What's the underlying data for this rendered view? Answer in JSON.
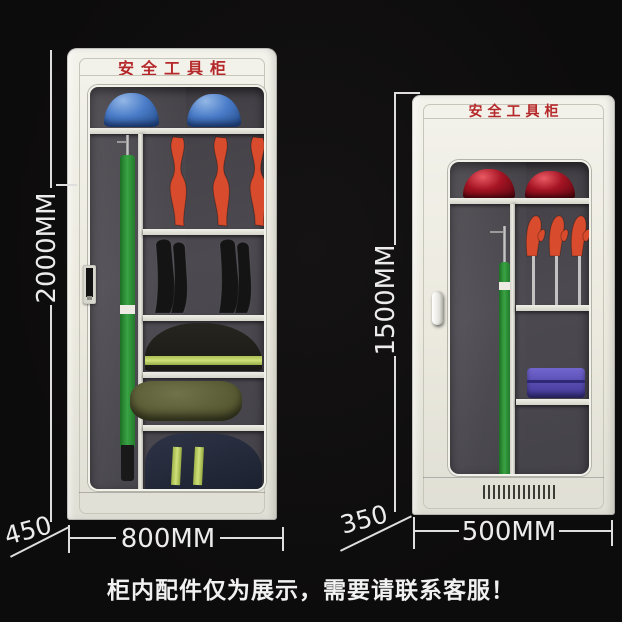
{
  "caption": {
    "text": "柜内配件仅为展示，需要请联系客服！"
  },
  "cabinet_large": {
    "sign": "安全工具柜",
    "dimensions": {
      "height": "2000MM",
      "width": "800MM",
      "depth": "450"
    },
    "contents": [
      "blue-safety-helmet",
      "blue-safety-helmet",
      "insulated-operating-rod",
      "insulated-glove",
      "insulated-glove",
      "insulated-glove",
      "insulated-boots",
      "safety-clothing-reflective",
      "tool-duffel-bag",
      "uniform-reflective-stripes"
    ]
  },
  "cabinet_small": {
    "sign": "安全工具柜",
    "dimensions": {
      "height": "1500MM",
      "width": "500MM",
      "depth": "350"
    },
    "contents": [
      "red-safety-helmet",
      "red-safety-helmet",
      "insulated-operating-rod",
      "insulated-glove",
      "insulated-glove",
      "insulated-glove",
      "tool-case"
    ]
  },
  "colors": {
    "background": "#0d0c0c",
    "cabinet_body": "#eceadf",
    "sign_red": "#b5282a",
    "helmet_blue": "#4a7cc8",
    "helmet_red": "#a51423",
    "pole_green": "#3aa344",
    "glove_orange": "#d84b2c",
    "toolbox_purple": "#5a4fb4",
    "reflective_stripe": "#cfe07a",
    "dimension_text": "#ececec",
    "interior_dark": "#4c4950"
  }
}
